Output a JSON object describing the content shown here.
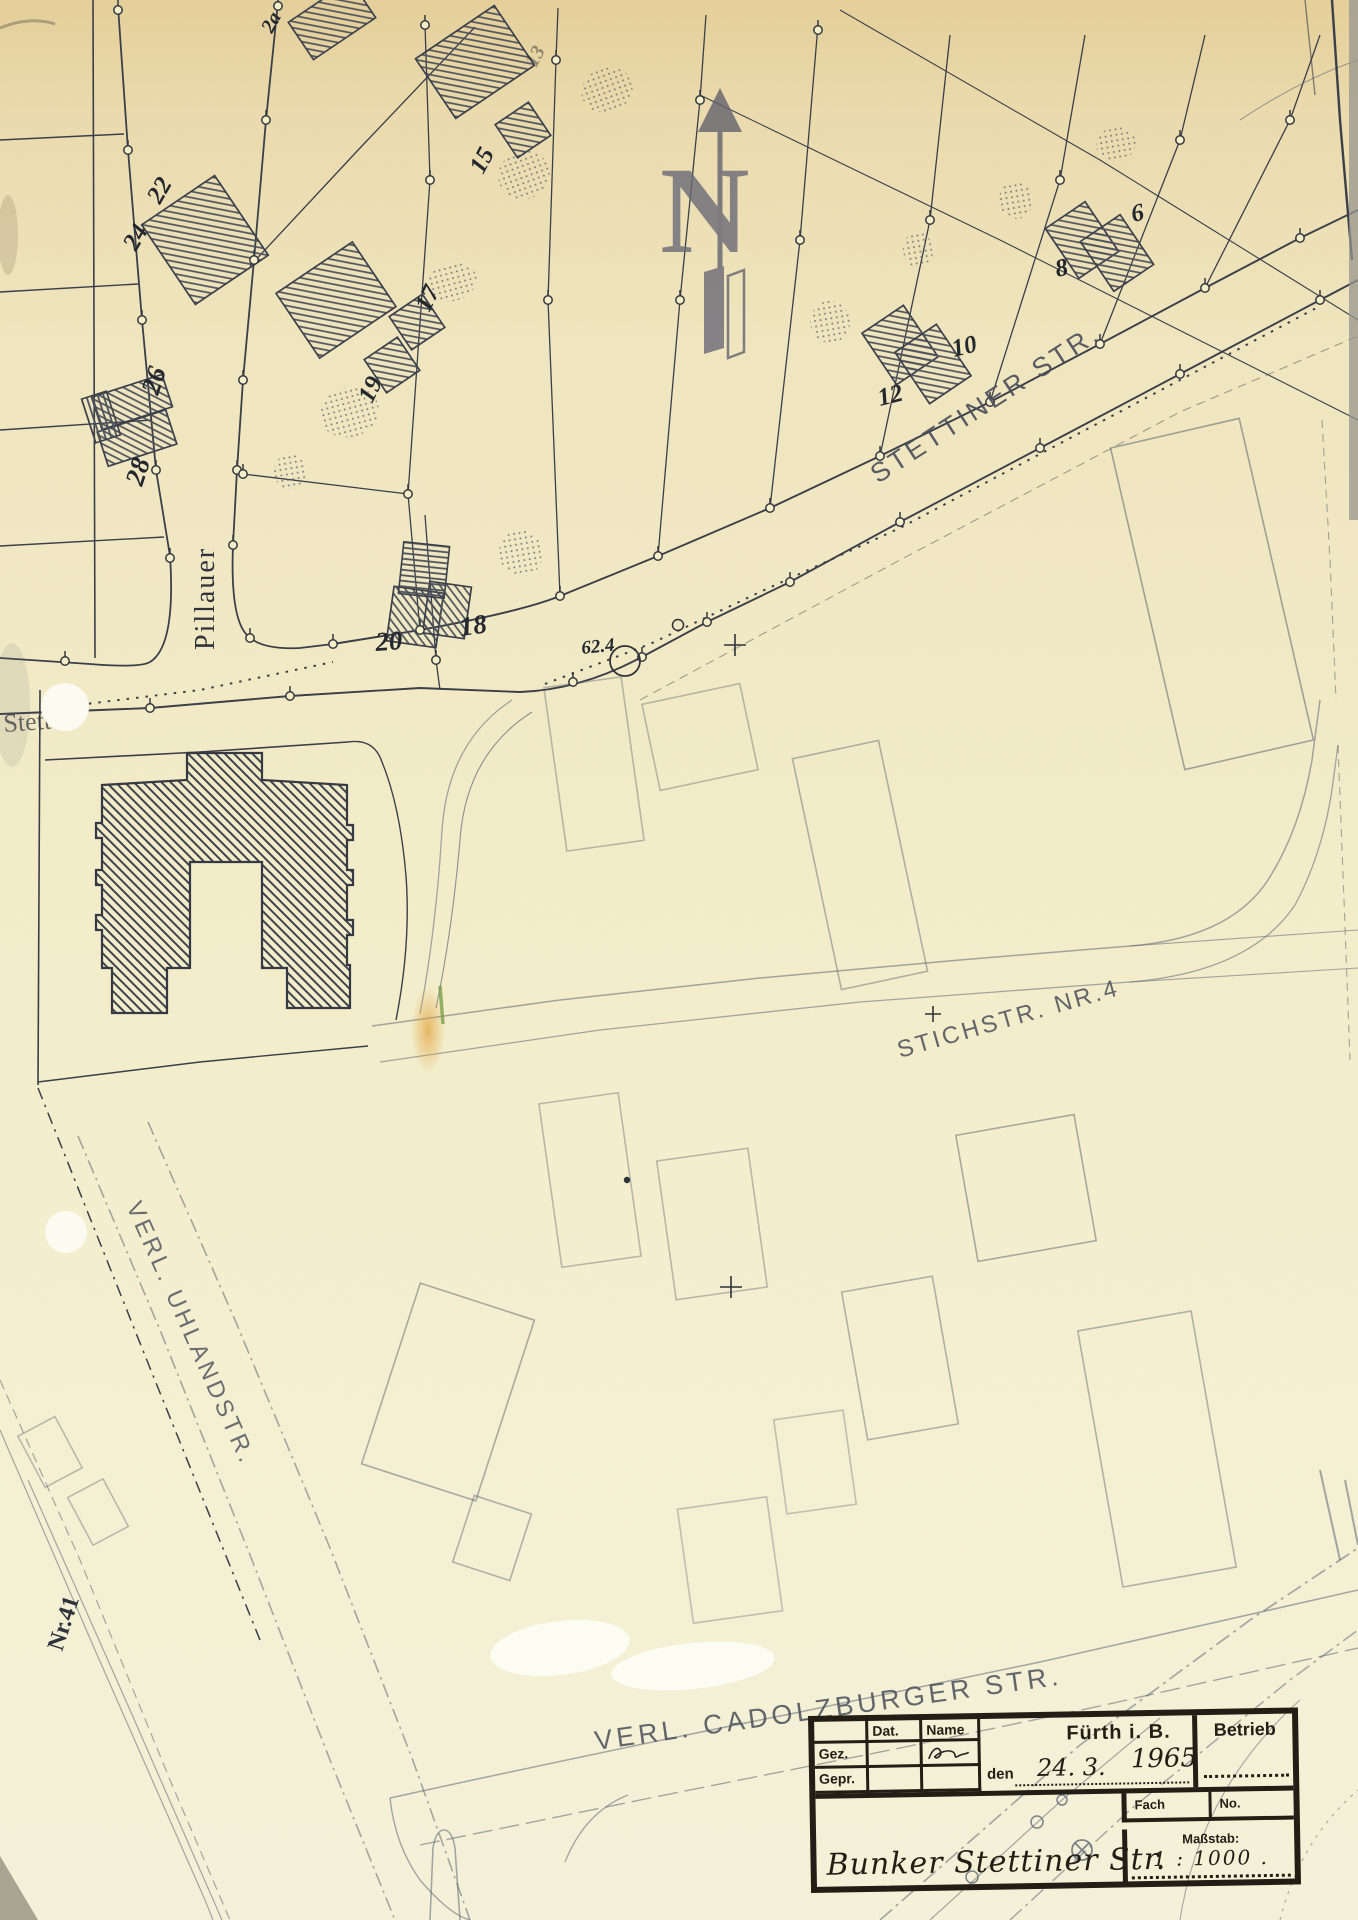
{
  "map": {
    "north_label": "N",
    "elevation_point": "62.4",
    "streets": {
      "stettiner": "STETTINER STR.",
      "pillauer": "Pillauer",
      "stettiner_cut": "Stett",
      "stichstr": "STICHSTR. NR.4",
      "uhlandstr": "VERL. UHLANDSTR.",
      "cadolzburger": "VERL. CADOLZBURGER STR.",
      "nr41": "Nr.41"
    },
    "house_numbers": {
      "n2a": "2a",
      "n13": "13",
      "n15": "15",
      "n17": "17",
      "n19": "19",
      "n22": "22",
      "n24": "24",
      "n26": "26",
      "n28": "28",
      "n20": "20",
      "n18": "18",
      "n12": "12",
      "n10": "10",
      "n8": "8",
      "n6": "6"
    }
  },
  "title_block": {
    "col_date": "Dat.",
    "col_name": "Name",
    "row_drawn": "Gez.",
    "row_checked": "Gepr.",
    "date_prefix": "den",
    "date_value": "24. 3.",
    "year_value": "1965",
    "city": "Fürth i. B.",
    "department": "Betrieb",
    "fach_label": "Fach",
    "no_label": "No.",
    "scale_label": "Maßstab:",
    "scale_value": "1 : 1000 .",
    "drawing_title": "Bunker Stettiner Str."
  }
}
